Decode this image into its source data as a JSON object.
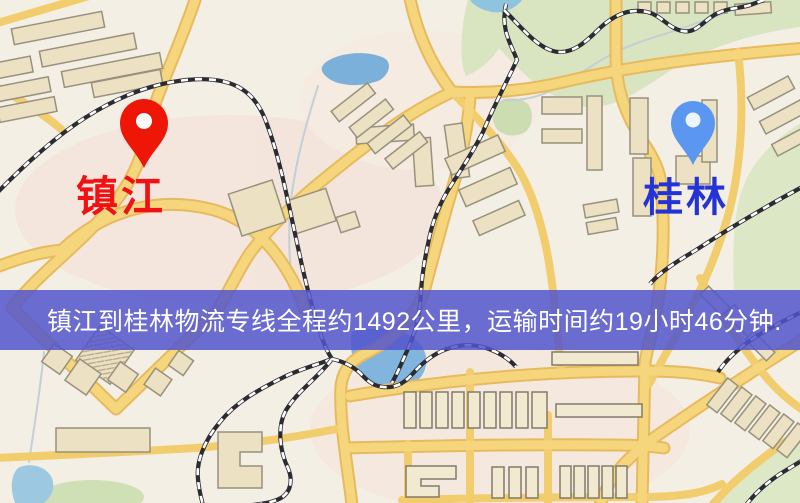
{
  "banner": {
    "text": "镇江到桂林物流专线全程约1492公里，运输时间约19小时46分钟.",
    "bg": "rgba(82,85,205,0.85)",
    "text_color": "#ffffff"
  },
  "map": {
    "markers": [
      {
        "name": "zhenjiang",
        "label": "镇江",
        "pin_color": "#ed1607",
        "pin_hole_color": "#ffffff",
        "label_color": "#f01212"
      },
      {
        "name": "guilin",
        "label": "桂林",
        "pin_color": "#5b97f0",
        "pin_hole_color": "#eef4fc",
        "label_color": "#2433d6"
      }
    ],
    "palette": {
      "background": "#f4efe4",
      "road_fill": "#f6d67c",
      "road_edge": "#e7ba5e",
      "road_minor": "#f2cd6e",
      "building_fill": "#ece1c2",
      "building_stroke": "#97917d",
      "park_green": "#d8e5c0",
      "water_blue": "#7bb0da",
      "railway_black": "#2b2b33"
    }
  }
}
